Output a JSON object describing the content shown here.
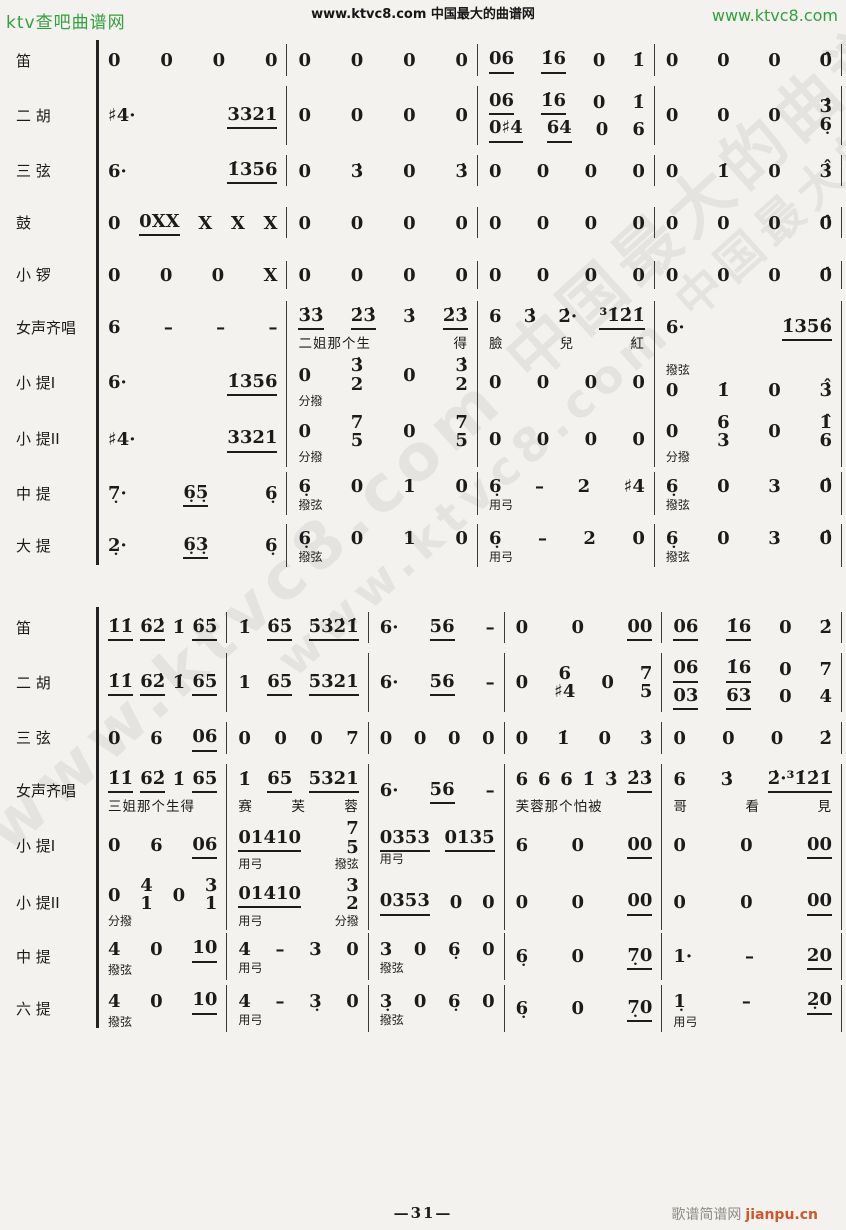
{
  "page": {
    "header": {
      "left_link": "ktv查吧曲谱网",
      "center_text": "www.ktvc8.com 中国最大的曲谱网",
      "right_link": "www.ktvc8.com",
      "link_color": "#33a03e"
    },
    "watermark": {
      "text": "www.ktvc8.com 中国最大的曲谱网"
    },
    "footer": {
      "page_number": "—31—",
      "site_name": "歌谱简谱网",
      "site_url": "jianpu.cn",
      "url_color": "#d4552a"
    }
  },
  "score": {
    "systems": [
      {
        "name": "system-1",
        "flex": [
          1,
          1,
          0.92,
          0.98
        ],
        "rows": [
          {
            "label": "笛",
            "measures": [
              "0 0 0 0",
              "0 0 0 0",
              "06 1̇6 0 1̇",
              "0 0 0 0̂"
            ]
          },
          {
            "label": "二 胡",
            "measures": [
              "♯4· 3321",
              "0 0 0 0",
              {
                "top": "06 1̇6 0 1̇",
                "bottom": "0♯4 64 0 6"
              },
              "0 0 0 3̂/6̣"
            ]
          },
          {
            "label": "三 弦",
            "measures": [
              "6· 1̇356",
              "0 3̇ 0 3̇",
              "0 0 0 0",
              "0 1̇ 0 3̇̂"
            ]
          },
          {
            "label": "鼓",
            "measures": [
              "0 0XX X X X",
              "0 0 0 0",
              "0 0 0 0",
              "0 0 0 0̂"
            ]
          },
          {
            "label": "小 锣",
            "measures": [
              "0 0 0 X",
              "0 0 0 0",
              "0 0 0 0",
              "0 0 0 0̂"
            ]
          },
          {
            "label": "女声齐唱",
            "measures": [
              {
                "notes": "6 – – –"
              },
              {
                "notes": "3̇3̇ 2̇3̇ 3̇ 2̇3̇",
                "lyrics": "二姐那个生 得"
              },
              {
                "notes": "6 3̇ 2̇· ³1̇2̇1̇",
                "lyrics": "臉 兒 紅"
              },
              {
                "notes": "6· 1̇356̂"
              }
            ]
          },
          {
            "label": "小 提I",
            "measures": [
              "6· 1̇356",
              {
                "notes": "0 3̇/2 0 3̇/2",
                "below": "分撥"
              },
              "0 0 0 0",
              {
                "notes": "0 1̇ 0 3̇̂",
                "above": "撥弦"
              }
            ]
          },
          {
            "label": "小 提II",
            "measures": [
              "♯4· 3321",
              {
                "notes": "0 7/5 0 7/5",
                "below": "分撥"
              },
              "0 0 0 0",
              {
                "notes": "0 6/3 0 1̂/6",
                "below": "分撥"
              }
            ]
          },
          {
            "label": "中 提",
            "measures": [
              "7̣· 6̣5̣ 6̣",
              {
                "notes": "6̣ 0 1 0",
                "below": "撥弦"
              },
              {
                "notes": "6̣ – 2 ♯4",
                "below": "用弓"
              },
              {
                "notes": "6̣ 0 3 0̂",
                "below": "撥弦"
              }
            ]
          },
          {
            "label": "大 提",
            "measures": [
              "2̣· 6̣3̣ 6̣",
              {
                "notes": "6̣ 0 1 0",
                "below": "撥弦"
              },
              {
                "notes": "6̣ – 2 0",
                "below": "用弓"
              },
              {
                "notes": "6̣ 0 3 0̂",
                "below": "撥弦"
              }
            ]
          }
        ]
      },
      {
        "name": "system-2",
        "flex": [
          1,
          1.1,
          1.05,
          1.25,
          1.45
        ],
        "rows": [
          {
            "label": "笛",
            "measures": [
              "1̇1̇ 6̇2̇ 1̇ 6̇5̇",
              "1̇ 6̇5̇ 5̇3̇2̇1̇",
              "6· 56 –",
              "0 0 00",
              "06 1̇6 0 2̇"
            ]
          },
          {
            "label": "二 胡",
            "measures": [
              "1̇1̇ 62̇ 1̇ 65",
              "1 65 5321",
              "6· 56 –",
              "0 6/♯4 0 7/5",
              {
                "top": "06 1̇6 0 7",
                "bottom": "03 63 0 4"
              }
            ]
          },
          {
            "label": "三 弦",
            "measures": [
              "0 6 06",
              "0 0 0 7",
              "0 0 0 0",
              "0 1̇ 0 3̇",
              "0 0 0 2̇"
            ]
          },
          {
            "label": "女声齐唱",
            "measures": [
              {
                "notes": "1̇1̇ 62̇ 1̇ 65",
                "lyrics": "三姐那个生得"
              },
              {
                "notes": "1̇ 65 5321",
                "lyrics": "赛 芙 蓉"
              },
              {
                "notes": "6· 56 –"
              },
              {
                "notes": "6 6 6 1̇ 3̇ 2̇3̇",
                "lyrics": "芙蓉那个怕被"
              },
              {
                "notes": "6 3̇ 2̇·³1̇2̇1̇",
                "lyrics": "哥 看 見"
              }
            ]
          },
          {
            "label": "小 提I",
            "measures": [
              "0 6 06",
              {
                "notes": "01410 7/5",
                "below": "用弓 撥弦"
              },
              {
                "notes": "0353 0135",
                "below": "用弓"
              },
              "6 0 00",
              "0 0 00"
            ]
          },
          {
            "label": "小 提II",
            "measures": [
              {
                "notes": "0 4/1 0 3/1",
                "below": "分撥"
              },
              {
                "notes": "01410 3/2",
                "below": "用弓 分撥"
              },
              "0353 0 0",
              "0 0 00",
              "0 0 00"
            ]
          },
          {
            "label": "中 提",
            "measures": [
              {
                "notes": "4 0 10",
                "below": "撥弦"
              },
              {
                "notes": "4 – 3 0",
                "below": "用弓"
              },
              {
                "notes": "3 0 6̣ 0",
                "below": "撥弦"
              },
              "6̣ 0 7̣0",
              "1· – 20"
            ]
          },
          {
            "label": "六 提",
            "measures": [
              {
                "notes": "4 0 10",
                "below": "撥弦"
              },
              {
                "notes": "4 – 3̣ 0",
                "below": "用弓"
              },
              {
                "notes": "3̣ 0 6̣ 0",
                "below": "撥弦"
              },
              "6̣ 0 7̣0",
              {
                "notes": "1̣ – 2̣0",
                "below": "用弓"
              }
            ]
          }
        ]
      }
    ]
  }
}
